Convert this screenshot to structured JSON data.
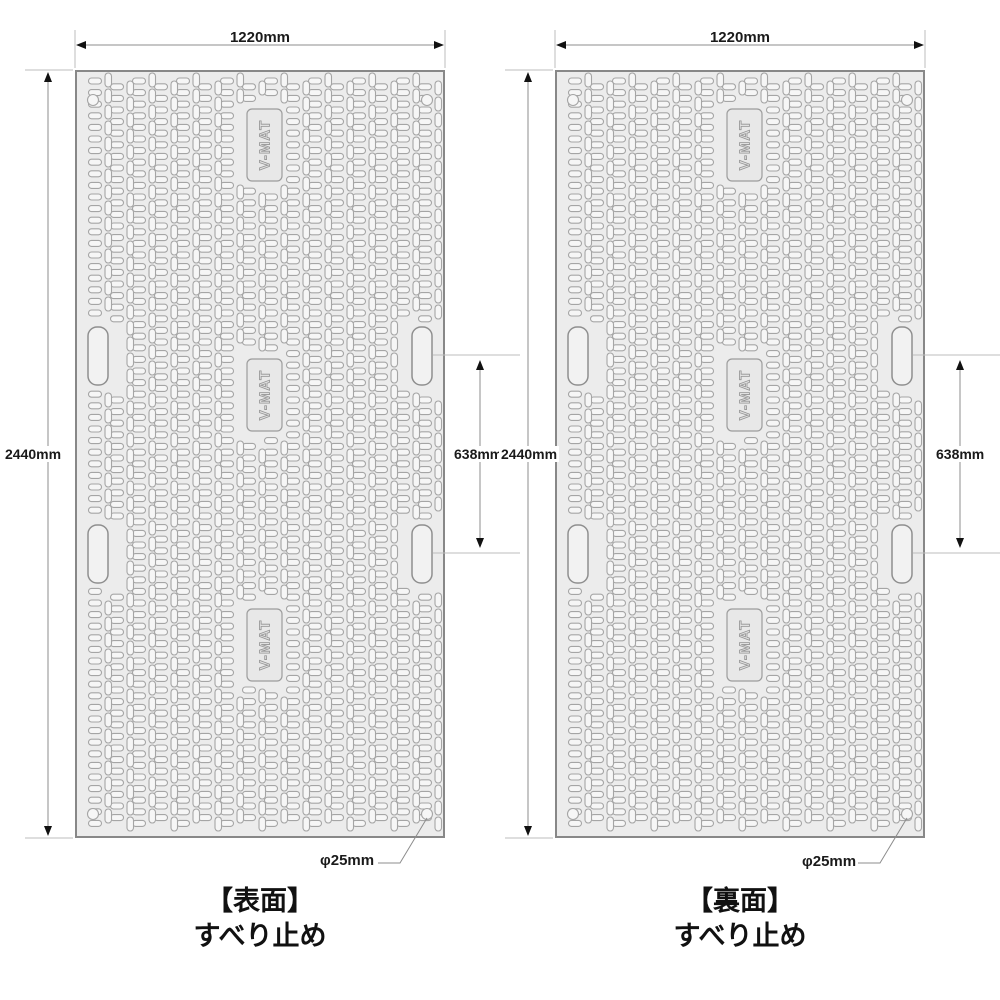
{
  "panels": [
    {
      "name": "front",
      "width_label": "1220mm",
      "height_label": "2440mm",
      "slot_pitch_label": "638mm",
      "hole_diameter_label": "φ25mm",
      "plate_text": "V-MAT",
      "caption_title": "【表面】",
      "caption_subtitle": "すべり止め"
    },
    {
      "name": "back",
      "width_label": "1220mm",
      "height_label": "2440mm",
      "slot_pitch_label": "638mm",
      "hole_diameter_label": "φ25mm",
      "plate_text": "V-MAT",
      "caption_title": "【裏面】",
      "caption_subtitle": "すべり止め"
    }
  ],
  "colors": {
    "panel_fill": "#ececec",
    "panel_border": "#888888",
    "hole_fill": "#f6f6f6",
    "hole_stroke": "#a5a5a5",
    "plate_fill": "#e8e8e8",
    "plate_stroke": "#9c9c9c",
    "ext_line": "#bdbdbd",
    "dim_line": "#8c8c8c",
    "arrow": "#111111",
    "text": "#1a1a1a"
  }
}
